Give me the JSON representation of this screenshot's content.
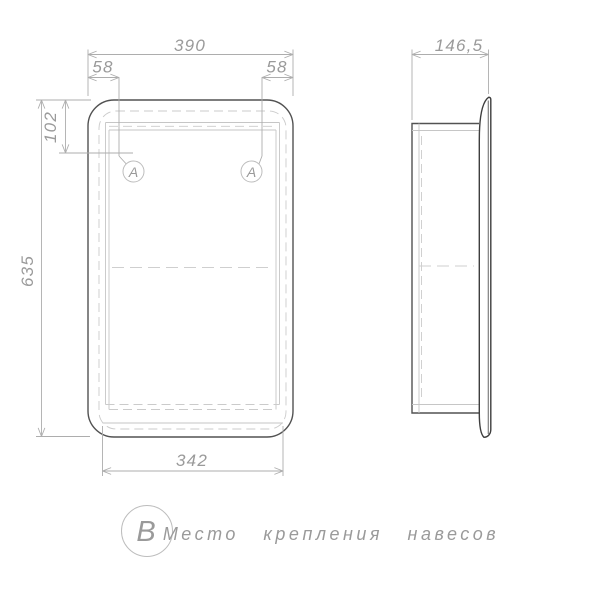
{
  "drawing_type": "furniture-technical-drawing",
  "dimensions": {
    "overall_width": "390",
    "hanger_offset_left": "58",
    "hanger_offset_right": "58",
    "hanger_offset_top": "102",
    "overall_height": "635",
    "bottom_width": "342",
    "overall_depth": "146,5"
  },
  "callouts": {
    "hanger_left": "А",
    "hanger_right": "А",
    "note_marker": "В",
    "note_text": "Место крепления навесов"
  },
  "colors": {
    "background": "#ffffff",
    "outline": "#525252",
    "door_profile": "#3e3e3e",
    "thin_lines": "#c6c6c6",
    "dimension_lines": "#adadad",
    "text": "#9a9a9a"
  }
}
